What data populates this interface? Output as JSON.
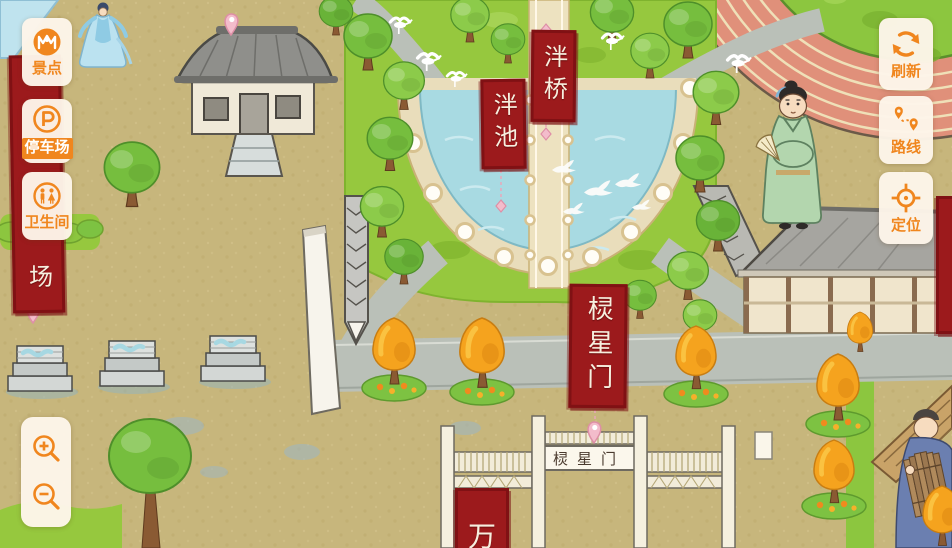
{
  "ui": {
    "colors": {
      "accent": "#F0861E",
      "panel": "#FCF4E8",
      "highlight_text": "#FFFFFF"
    },
    "sidebar": {
      "items": [
        {
          "label": "景点",
          "icon": "scenic-spots-icon",
          "highlighted": false
        },
        {
          "label": "停车场",
          "icon": "parking-icon",
          "highlighted": true
        },
        {
          "label": "卫生间",
          "icon": "restroom-icon",
          "highlighted": false
        }
      ]
    },
    "toolbar": {
      "items": [
        {
          "label": "刷新",
          "icon": "refresh-icon"
        },
        {
          "label": "路线",
          "icon": "route-icon"
        },
        {
          "label": "定位",
          "icon": "locate-icon"
        }
      ]
    },
    "zoom_controls": {
      "icons": [
        "zoom-in-icon",
        "zoom-out-icon"
      ]
    }
  },
  "map": {
    "colors": {
      "banner": "#9C1A1C",
      "banner_border": "#801114",
      "ground": "#C7B67C",
      "water": "#A8DAE2",
      "grass": "#96C83E",
      "road": "#BAC0B8",
      "track": "#E0907A"
    },
    "labels": {
      "pan_bridge": "泮桥",
      "pan_pond": "泮池",
      "lingxing_gate_banner": "棂星门",
      "gate_plaque": "棂星门",
      "parking_banner_visible": "场",
      "south_banner_partial": "万"
    }
  }
}
